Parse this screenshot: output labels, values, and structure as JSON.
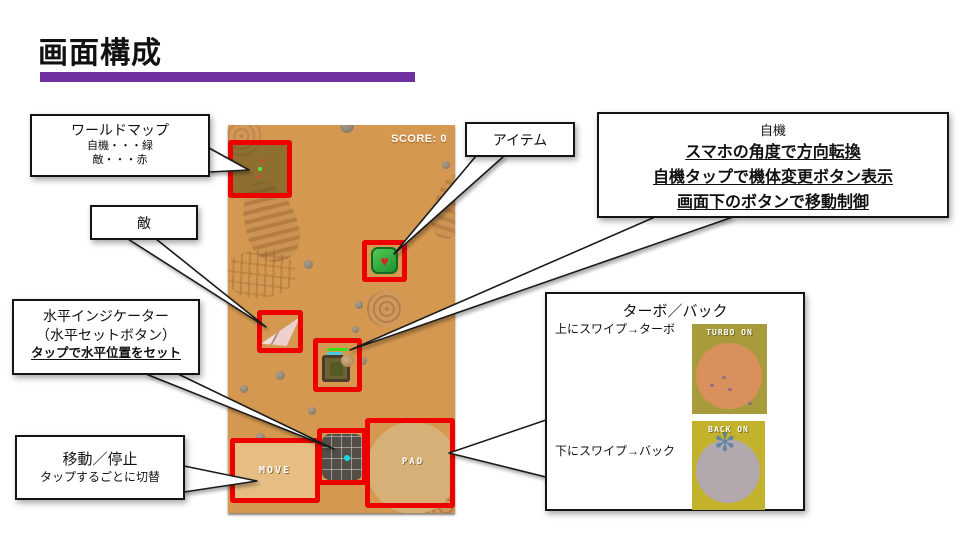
{
  "slide": {
    "title": "画面構成",
    "accent_color": "#7030a0",
    "background_color": "#ffffff",
    "highlight_box_color": "#ee0000"
  },
  "game": {
    "score_label": "SCORE: 0",
    "move_label": "MOVE",
    "pad_label": "PAD",
    "background_color": "#d59850",
    "indicator_dot_color": "#17d8e8",
    "heart_icon": "♥"
  },
  "callouts": {
    "worldmap": {
      "title": "ワールドマップ",
      "line1": "自機・・・緑",
      "line2": "敵・・・赤"
    },
    "enemy": {
      "title": "敵"
    },
    "horizontal": {
      "line1": "水平インジケーター",
      "line2": "（水平セットボタン）",
      "line3": "タップで水平位置をセット"
    },
    "move": {
      "title": "移動／停止",
      "line1": "タップするごとに切替"
    },
    "item": {
      "title": "アイテム"
    },
    "player": {
      "title": "自機",
      "line1": "スマホの角度で方向転換",
      "line2": "自機タップで機体変更ボタン表示",
      "line3": "画面下のボタンで移動制御"
    },
    "turboback": {
      "title": "ターボ／バック",
      "swipe_up": "上にスワイプ→ターボ",
      "swipe_down": "下にスワイプ→バック",
      "turbo_label": "TURBO ON",
      "back_label": "BACK ON",
      "turbo_bg_color": "#a79b3b",
      "turbo_circle_color": "#d9905c",
      "back_bg_color": "#c3b22c",
      "back_circle_color": "#b3a8ad",
      "flower_icon": "✻"
    }
  }
}
